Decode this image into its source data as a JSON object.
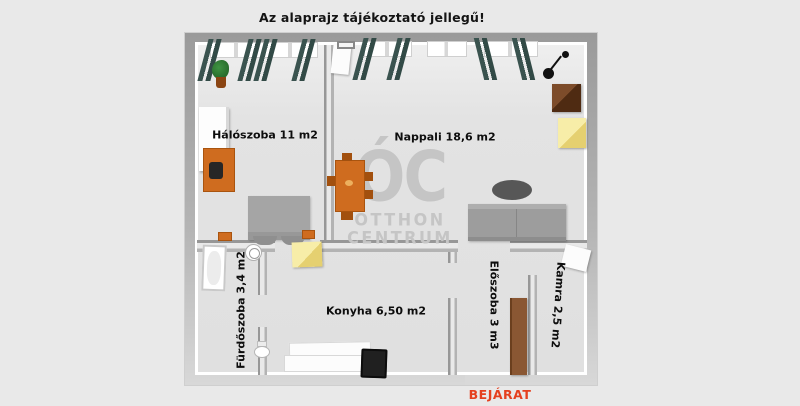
{
  "page": {
    "background": "#e9e9e9",
    "disclaimer": "Az alaprajz tájékoztató jellegű!"
  },
  "watermark": {
    "monogram": "ÓC",
    "name_line1": "OTTHON",
    "name_line2": "CENTRUM",
    "color": "#c5c5c5"
  },
  "entrance": {
    "label": "BEJÁRAT",
    "color": "#e5401f"
  },
  "rooms": [
    {
      "name": "bedroom",
      "label": "Hálószoba 11 m2"
    },
    {
      "name": "living-room",
      "label": "Nappali 18,6 m2"
    },
    {
      "name": "bathroom",
      "label": "Fürdőszoba 3,4 m2"
    },
    {
      "name": "kitchen",
      "label": "Konyha 6,50 m2"
    },
    {
      "name": "hallway",
      "label": "Előszoba 3 m3"
    },
    {
      "name": "pantry",
      "label": "Kamra 2,5 m2"
    }
  ],
  "colors": {
    "wall": "#ababab",
    "floor": "#e3e3e3",
    "curtain": "#3a534f",
    "wood_accent": "#cf6c1f",
    "watermark_gray": "#c5c5c5",
    "entrance_red": "#e5401f"
  }
}
